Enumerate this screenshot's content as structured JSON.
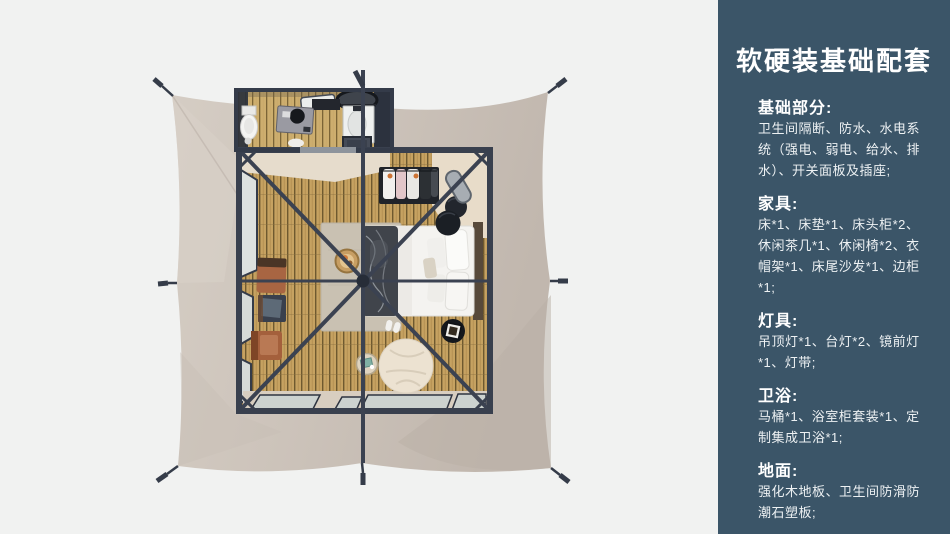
{
  "palette": {
    "page-bg": "#f1f2f1",
    "panel-bg": "#3b5568",
    "panel-text": "#ffffff",
    "panel-body-text": "#edf1f3",
    "canvas-light": "#d4ccc3",
    "canvas-mid": "#cdc4bb",
    "canvas-dark": "#c0b6ad",
    "frame": "#39404e",
    "wood": "#c6a261",
    "glass": "#ccd2cf",
    "bedding": "#f4f3f0",
    "blanket": "#40444b",
    "leather": "#a4603c",
    "beige-floor": "#e6dccc"
  },
  "panel": {
    "title": "软硬装基础配套",
    "sections": [
      {
        "heading": "基础部分:",
        "body": "卫生间隔断、防水、水电系统（强电、弱电、给水、排水）、开关面板及插座;"
      },
      {
        "heading": "家具:",
        "body": "床*1、床垫*1、床头柜*2、休闲茶几*1、休闲椅*2、衣帽架*1、床尾沙发*1、边柜*1;"
      },
      {
        "heading": "灯具:",
        "body": "吊顶灯*1、台灯*2、镜前灯*1、灯带;"
      },
      {
        "heading": "卫浴:",
        "body": "马桶*1、浴室柜套装*1、定制集成卫浴*1;"
      },
      {
        "heading": "地面:",
        "body": "强化木地板、卫生间防滑防潮石塑板;"
      }
    ]
  }
}
